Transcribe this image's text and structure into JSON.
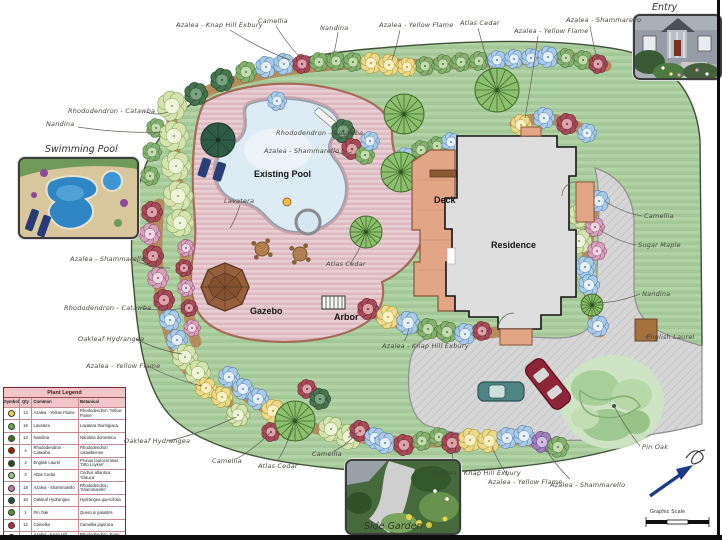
{
  "plan": {
    "labels": [
      {
        "t": "Nandina",
        "x": 46,
        "y": 120,
        "k": "hw",
        "l": [
          78,
          127,
          162,
          132
        ]
      },
      {
        "t": "Azalea - Knap Hill Exbury",
        "x": 176,
        "y": 21,
        "k": "hw",
        "l": [
          230,
          30,
          290,
          60
        ]
      },
      {
        "t": "Camellia",
        "x": 258,
        "y": 17,
        "k": "hw",
        "l": [
          276,
          26,
          301,
          58
        ]
      },
      {
        "t": "Nandina",
        "x": 320,
        "y": 24,
        "k": "hw",
        "l": [
          338,
          32,
          333,
          56
        ]
      },
      {
        "t": "Azalea - Yellow Flame",
        "x": 379,
        "y": 21,
        "k": "hw",
        "l": [
          400,
          30,
          392,
          60
        ]
      },
      {
        "t": "Atlas Cedar",
        "x": 460,
        "y": 19,
        "k": "hw",
        "l": [
          478,
          28,
          495,
          84
        ]
      },
      {
        "t": "Azalea - Yellow Flame",
        "x": 514,
        "y": 27,
        "k": "hw",
        "l": [
          538,
          36,
          525,
          118
        ]
      },
      {
        "t": "Azalea - Shammarello",
        "x": 566,
        "y": 16,
        "k": "hw",
        "l": [
          590,
          26,
          597,
          58
        ]
      },
      {
        "t": "Rhododendron - Catawba",
        "x": 68,
        "y": 107,
        "k": "hw",
        "l": [
          146,
          112,
          168,
          112
        ]
      },
      {
        "t": "Rhododendron - Catawba",
        "x": 276,
        "y": 129,
        "k": "hw",
        "l": [
          344,
          133,
          348,
          142
        ]
      },
      {
        "t": "Azalea - Shammarello",
        "x": 264,
        "y": 147,
        "k": "hw",
        "l": [
          334,
          151,
          352,
          152
        ]
      },
      {
        "t": "Lavatera",
        "x": 224,
        "y": 197,
        "k": "hw",
        "l": [
          240,
          205,
          230,
          228
        ]
      },
      {
        "t": "Atlas Cedar",
        "x": 326,
        "y": 260,
        "k": "hw",
        "l": [
          350,
          264,
          364,
          238
        ]
      },
      {
        "t": "Azalea - Shammarello",
        "x": 70,
        "y": 255,
        "k": "hw",
        "l": [
          134,
          260,
          170,
          268
        ]
      },
      {
        "t": "Rhododendron - Catawba",
        "x": 64,
        "y": 304,
        "k": "hw",
        "l": [
          142,
          308,
          184,
          308
        ]
      },
      {
        "t": "Oakleaf Hydrangea",
        "x": 78,
        "y": 335,
        "k": "hw",
        "l": [
          136,
          339,
          182,
          354
        ]
      },
      {
        "t": "Azalea - Yellow Flame",
        "x": 86,
        "y": 362,
        "k": "hw",
        "l": [
          148,
          366,
          202,
          386
        ]
      },
      {
        "t": "Azalea - Knap Hill Exbury",
        "x": 382,
        "y": 342,
        "k": "hw",
        "l": [
          404,
          341,
          409,
          328
        ]
      },
      {
        "t": "Camellia",
        "x": 644,
        "y": 212,
        "k": "hw",
        "l": [
          642,
          216,
          606,
          202
        ]
      },
      {
        "t": "Sugar Maple",
        "x": 638,
        "y": 241,
        "k": "hw",
        "l": [
          636,
          245,
          600,
          230
        ]
      },
      {
        "t": "Nandina",
        "x": 642,
        "y": 290,
        "k": "hw",
        "l": [
          640,
          294,
          598,
          303
        ]
      },
      {
        "t": "English Laurel",
        "x": 646,
        "y": 333,
        "k": "hw",
        "l": [
          644,
          336,
          652,
          333
        ]
      },
      {
        "t": "Pin Oak",
        "x": 642,
        "y": 443,
        "k": "hw",
        "l": [
          640,
          446,
          614,
          406
        ]
      },
      {
        "t": "Oakleaf Hydrangea",
        "x": 124,
        "y": 437,
        "k": "hw",
        "l": [
          168,
          441,
          236,
          417
        ]
      },
      {
        "t": "Camellia",
        "x": 212,
        "y": 457,
        "k": "hw",
        "l": [
          236,
          459,
          270,
          433
        ]
      },
      {
        "t": "Atlas Cedar",
        "x": 258,
        "y": 462,
        "k": "hw",
        "l": [
          278,
          460,
          293,
          428
        ]
      },
      {
        "t": "Camellia",
        "x": 312,
        "y": 450,
        "k": "hw",
        "l": [
          334,
          451,
          358,
          432
        ]
      },
      {
        "t": "Azalea - Knap Hill Exbury",
        "x": 434,
        "y": 469,
        "k": "hw",
        "l": [
          454,
          467,
          452,
          447
        ]
      },
      {
        "t": "Azalea - Yellow Flame",
        "x": 488,
        "y": 478,
        "k": "hw",
        "l": [
          508,
          476,
          492,
          447
        ]
      },
      {
        "t": "Azalea - Shammarello",
        "x": 550,
        "y": 481,
        "k": "hw",
        "l": [
          570,
          479,
          545,
          448
        ]
      },
      {
        "t": "Existing Pool",
        "x": 254,
        "y": 169,
        "k": "area"
      },
      {
        "t": "Deck",
        "x": 434,
        "y": 195,
        "k": "area"
      },
      {
        "t": "Residence",
        "x": 491,
        "y": 240,
        "k": "area"
      },
      {
        "t": "Gazebo",
        "x": 250,
        "y": 306,
        "k": "area"
      },
      {
        "t": "Arbor",
        "x": 334,
        "y": 312,
        "k": "area"
      },
      {
        "t": "Swimming Pool",
        "x": 45,
        "y": 144,
        "k": "title"
      },
      {
        "t": "Entry",
        "x": 652,
        "y": 2,
        "k": "title"
      },
      {
        "t": "Side Garden",
        "x": 364,
        "y": 521,
        "k": "title"
      },
      {
        "t": "Graphic Scale",
        "x": 650,
        "y": 509,
        "k": "scale"
      }
    ]
  },
  "legend": {
    "title": "Plant Legend",
    "columns": [
      "Symbol",
      "Qty",
      "Common",
      "Botanical"
    ],
    "rows": [
      {
        "sym": "#e8d44d",
        "qty": "14",
        "common": "Azalea - Yellow Flame",
        "botanical": "Rhododendron 'Yellow Flame'"
      },
      {
        "sym": "#6aa84f",
        "qty": "16",
        "common": "Lavatera",
        "botanical": "Lavatera thuringiaca"
      },
      {
        "sym": "#38761d",
        "qty": "14",
        "common": "Nandina",
        "botanical": "Nandina domestica"
      },
      {
        "sym": "#a61c00",
        "qty": "4",
        "common": "Rhododendron - Catawba",
        "botanical": "Rhododendron catawbiense"
      },
      {
        "sym": "#274e13",
        "qty": "4",
        "common": "English Laurel",
        "botanical": "Prunus laurocerasus 'Otto Luyken'"
      },
      {
        "sym": "#93c47d",
        "qty": "3",
        "common": "Atlas Cedar",
        "botanical": "Cedrus atlantica 'Glauca'"
      },
      {
        "sym": "#c27ba0",
        "qty": "18",
        "common": "Azalea - Shammarello",
        "botanical": "Rhododendron 'Shammarello'"
      },
      {
        "sym": "#1a5632",
        "qty": "10",
        "common": "Oakleaf Hydrangea",
        "botanical": "Hydrangea quercifolia"
      },
      {
        "sym": "#4c9a2a",
        "qty": "1",
        "common": "Pin Oak",
        "botanical": "Quercus palustris"
      },
      {
        "sym": "#b03040",
        "qty": "12",
        "common": "Camellia",
        "botanical": "Camellia japonica"
      },
      {
        "sym": "#6fa8dc",
        "qty": "19",
        "common": "Azalea - Knap Hill Exbury",
        "botanical": "Rhododendron 'Knap Hill Exbury'"
      }
    ]
  }
}
